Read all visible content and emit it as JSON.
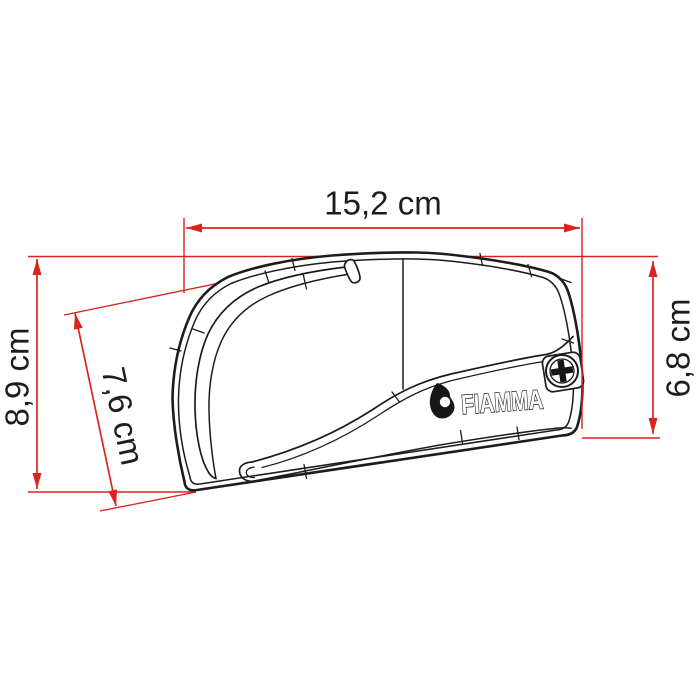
{
  "diagram": {
    "type": "technical-dimension-drawing",
    "dimensions": {
      "top_width": "15,2 cm",
      "left_height": "8,9 cm",
      "front_slant": "7,6 cm",
      "right_height": "6,8 cm"
    },
    "product": {
      "logo_text": "FIAMMA"
    },
    "colors": {
      "dimension_red": "#d9241f",
      "outline_black": "#1c1c1c",
      "background": "#ffffff"
    }
  }
}
